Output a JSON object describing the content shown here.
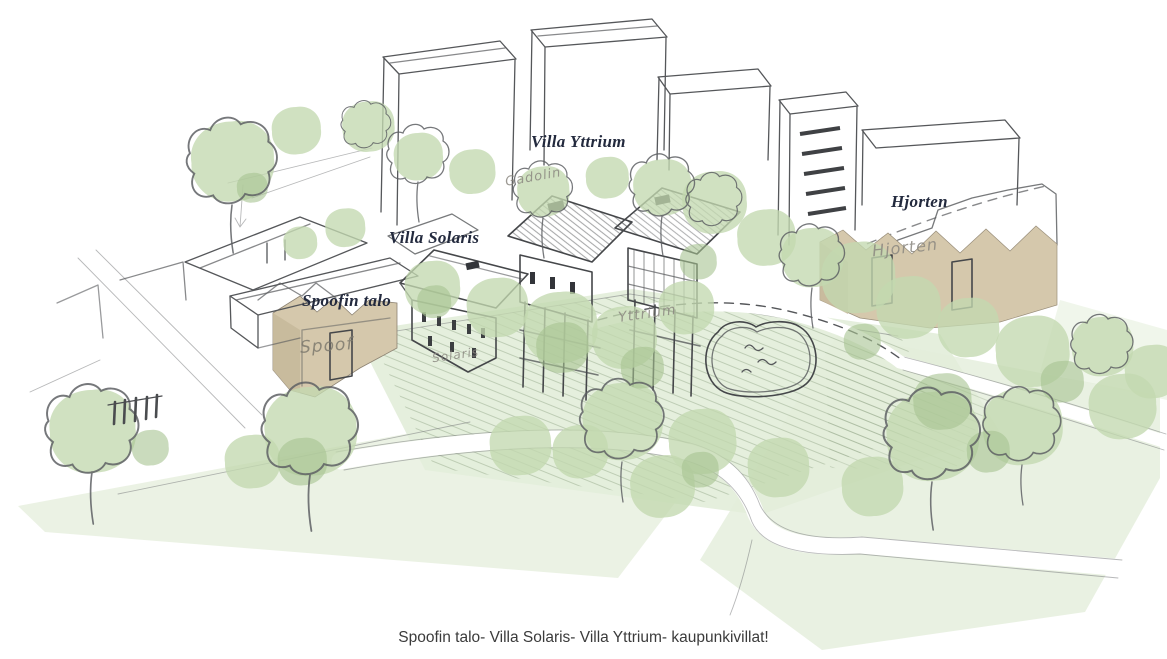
{
  "labels": {
    "villa_yttrium": "Villa Yttrium",
    "villa_solaris": "Villa Solaris",
    "spoofin_talo": "Spoofin talo",
    "hjorten": "Hjorten"
  },
  "handwritten": {
    "gadolin": "Gadolin",
    "spoof": "Spoof",
    "solaris": "Solaris",
    "yttrium": "Yttrium",
    "hjorten": "Hjorten"
  },
  "caption": "Spoofin talo- Villa Solaris- Villa Yttrium- kaupunkivillat!",
  "colors": {
    "canopy": "#c3d9b0",
    "canopy_dark": "#a6c391",
    "wash": "#e4eedb",
    "wash_light": "#edf4e6",
    "beige": "#d5c8ac",
    "beige_dark": "#c7b99b",
    "villa_pink_roof": "#f3dcd0",
    "villa_pink_wall": "#f7e6da",
    "villa_gray_roof": "#8e9096",
    "villa_gray_wall": "#adb0b5",
    "villa_brown_roof": "#b19e7e",
    "villa_brown_wall": "#bcab8c",
    "pond_fill": "#eef4e8",
    "pencil": "#55575a",
    "label_ink": "#232a3e",
    "handwriting": "#8b8880",
    "caption_ink": "#3b3b3b"
  }
}
